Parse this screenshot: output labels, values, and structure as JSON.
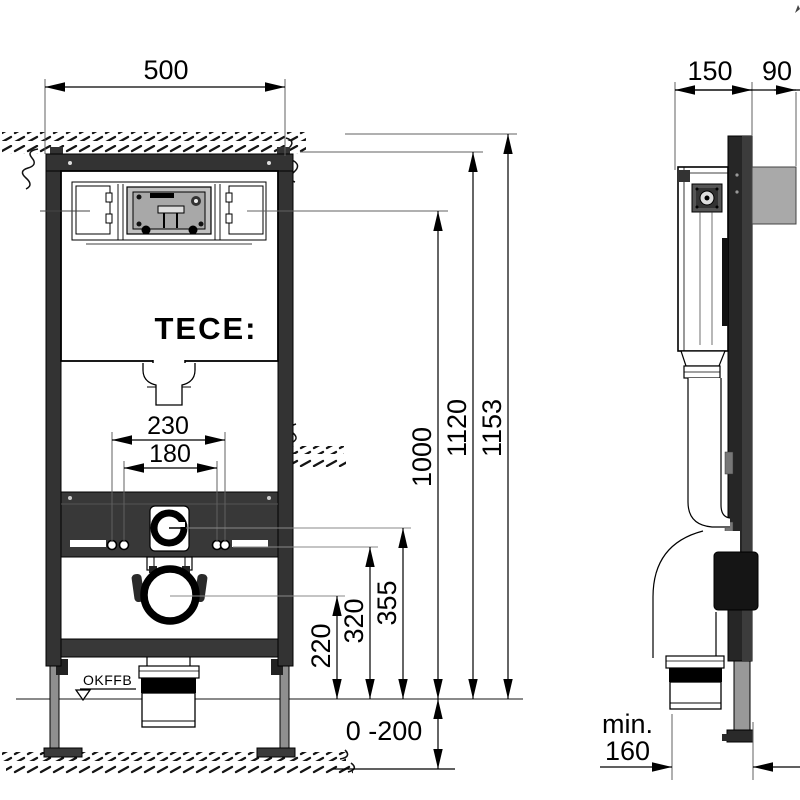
{
  "drawing_title": "TECE WC installation frame dimension drawing",
  "labels": {
    "brand": "TECE:",
    "floor_level": "OKFFB"
  },
  "dims": {
    "front": {
      "width": "500",
      "bolt_spacing_outer": "230",
      "bolt_spacing_inner": "180",
      "total_height": "1153",
      "top_edge_height": "1120",
      "inlet_height": "1000",
      "flush_pipe_height": "355",
      "fixing_bolt_height": "320",
      "drain_height": "220",
      "floor_buildup_range": "0 -200"
    },
    "side": {
      "frame_depth": "150",
      "wall_offset": "90",
      "min_clearance_prefix": "min.",
      "min_clearance_value": "160"
    }
  },
  "colors": {
    "frame_dark": "#333333",
    "steel_gray": "#a9a9a9",
    "line_black": "#000000",
    "dim_gray": "#606060"
  }
}
